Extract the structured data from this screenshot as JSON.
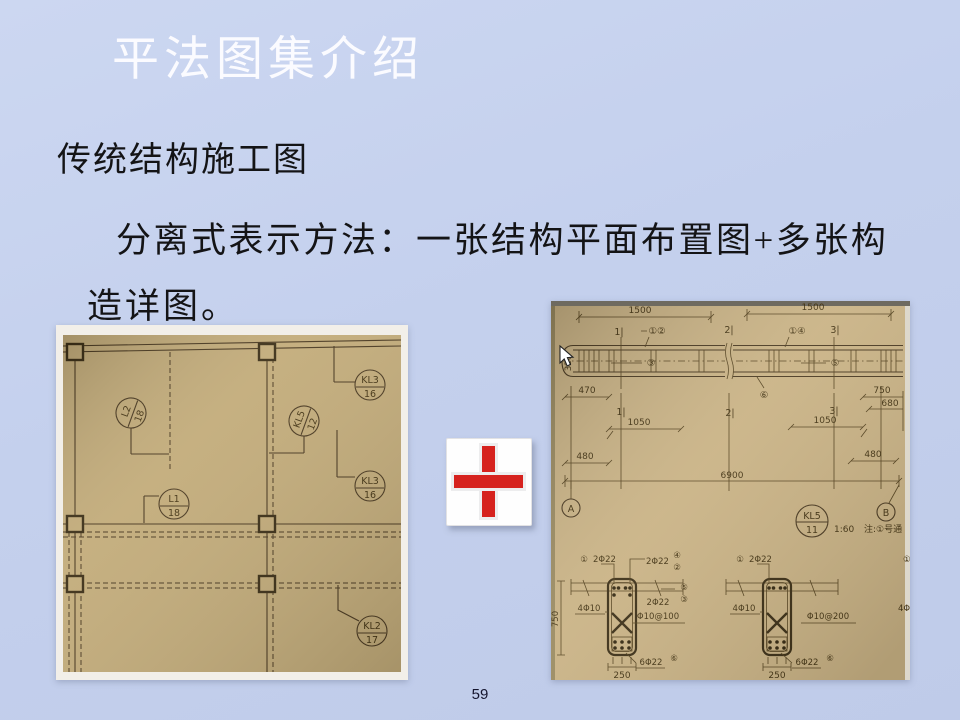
{
  "slide": {
    "title": "平法图集介绍",
    "paragraph1": "传统结构施工图",
    "paragraph2_line1": "分离式表示方法：一张结构平面布置图+多张构",
    "paragraph2_line2": "造详图。",
    "page_number": "59"
  },
  "colors": {
    "background": "#c4d0ed",
    "title_text": "#fbfbff",
    "body_text": "#141416",
    "plus_red": "#d6221e",
    "paper_left": "#c2ab79",
    "paper_right": "#c9b284",
    "drawing_ink": "#4a3920"
  },
  "left_plan": {
    "tags": [
      {
        "name": "L2",
        "num": "18"
      },
      {
        "name": "KL5",
        "num": "12"
      },
      {
        "name": "KL3",
        "num": "16"
      },
      {
        "name": "KL3",
        "num": "16"
      },
      {
        "name": "L1",
        "num": "18"
      },
      {
        "name": "KL2",
        "num": "17"
      }
    ]
  },
  "right_detail": {
    "top_dims": [
      "1500",
      "1500"
    ],
    "sections_top": [
      "1|",
      "①②",
      "2|",
      "①④",
      "3|"
    ],
    "beam_tags": [
      "③",
      "⑤",
      "⑥"
    ],
    "side_dim": "320",
    "mid_dims": [
      "470",
      "750",
      "680",
      "1|",
      "2|",
      "3|",
      "1050",
      "1050",
      "480",
      "480",
      "6900"
    ],
    "grid_bubbles": [
      "A",
      "B"
    ],
    "beam_id": {
      "name": "KL5",
      "num": "11"
    },
    "scale": "1:60",
    "note": "注:①号通",
    "sec_left": {
      "bar1_tag": "①",
      "bar1": "2Φ22",
      "bar2": "2Φ22",
      "bar2_tag_a": "④",
      "bar2_tag_b": "②",
      "side_tag_a": "⑤",
      "side_tag_b": "③",
      "bar3": "2Φ22",
      "web": "4Φ10",
      "stirrup": "Φ10@100",
      "bottom": "6Φ22",
      "bottom_tag": "⑥",
      "width": "250",
      "height": "750"
    },
    "sec_right": {
      "bar1_tag": "①",
      "bar1": "2Φ22",
      "web": "4Φ10",
      "stirrup": "Φ10@200",
      "bottom": "6Φ22",
      "bottom_tag": "⑥",
      "width": "250"
    },
    "edge_partials": [
      "①",
      "4Φ"
    ]
  }
}
